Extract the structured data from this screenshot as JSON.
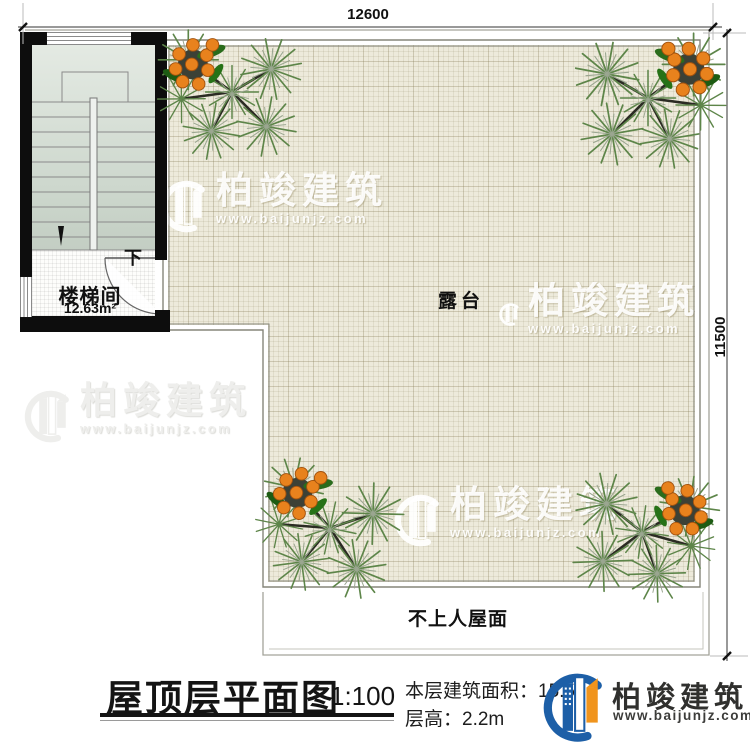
{
  "dimensions": {
    "top": "12600",
    "right": "11500"
  },
  "rooms": {
    "stairwell": {
      "label": "楼梯间",
      "area": "12.63m²",
      "direction": "下"
    },
    "terrace": {
      "label": "露台"
    },
    "roof": {
      "label": "不上人屋面"
    }
  },
  "footer": {
    "title": "屋顶层平面图",
    "scale": "1:100",
    "floor_area_label": "本层建筑面积：",
    "floor_area_value": "15.5",
    "floor_height_label": "层高：",
    "floor_height_value": "2.2m"
  },
  "brand": {
    "name": "柏竣建筑",
    "url": "www.baijunjz.com"
  },
  "watermark": {
    "name": "柏竣建筑",
    "url": "www.baijunjz.com"
  },
  "colors": {
    "terrace_bg": "#edeadb",
    "wall": "#0d0d0d",
    "brand_blue": "#1d5fa7",
    "brand_orange": "#f0941d",
    "berry_orange": "#e8821d",
    "needle_green": "#5d8549"
  }
}
